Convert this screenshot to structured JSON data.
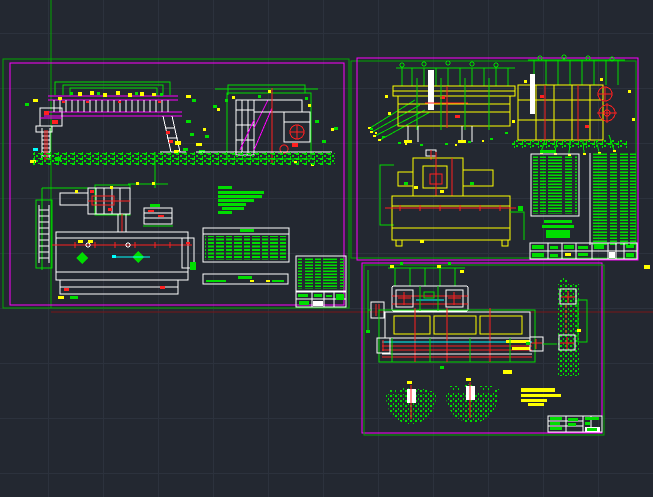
{
  "canvas": {
    "width": 653,
    "height": 497,
    "grid_spacing_px": 55
  },
  "palette": {
    "background": "#232831",
    "grid": "#2c323d",
    "border_green": "#00a800",
    "border_magenta": "#ff00ff",
    "green": "#00dd00",
    "magenta": "#ff00ff",
    "yellow": "#ffff00",
    "red": "#ff2020",
    "white": "#ffffff",
    "cyan": "#00ffff",
    "darkred": "#7a1616"
  },
  "sheets": [
    {
      "id": "sheet-1",
      "position": "top-left",
      "content": "assembly elevations, plan view, notes, parts list, title block"
    },
    {
      "id": "sheet-2",
      "position": "top-right",
      "content": "two callout elevations, plan view, two parts lists, title block"
    },
    {
      "id": "sheet-3",
      "position": "bottom-right",
      "content": "drum end view, long section, hatched saddle sections, hatched pier, notes, title block"
    }
  ]
}
